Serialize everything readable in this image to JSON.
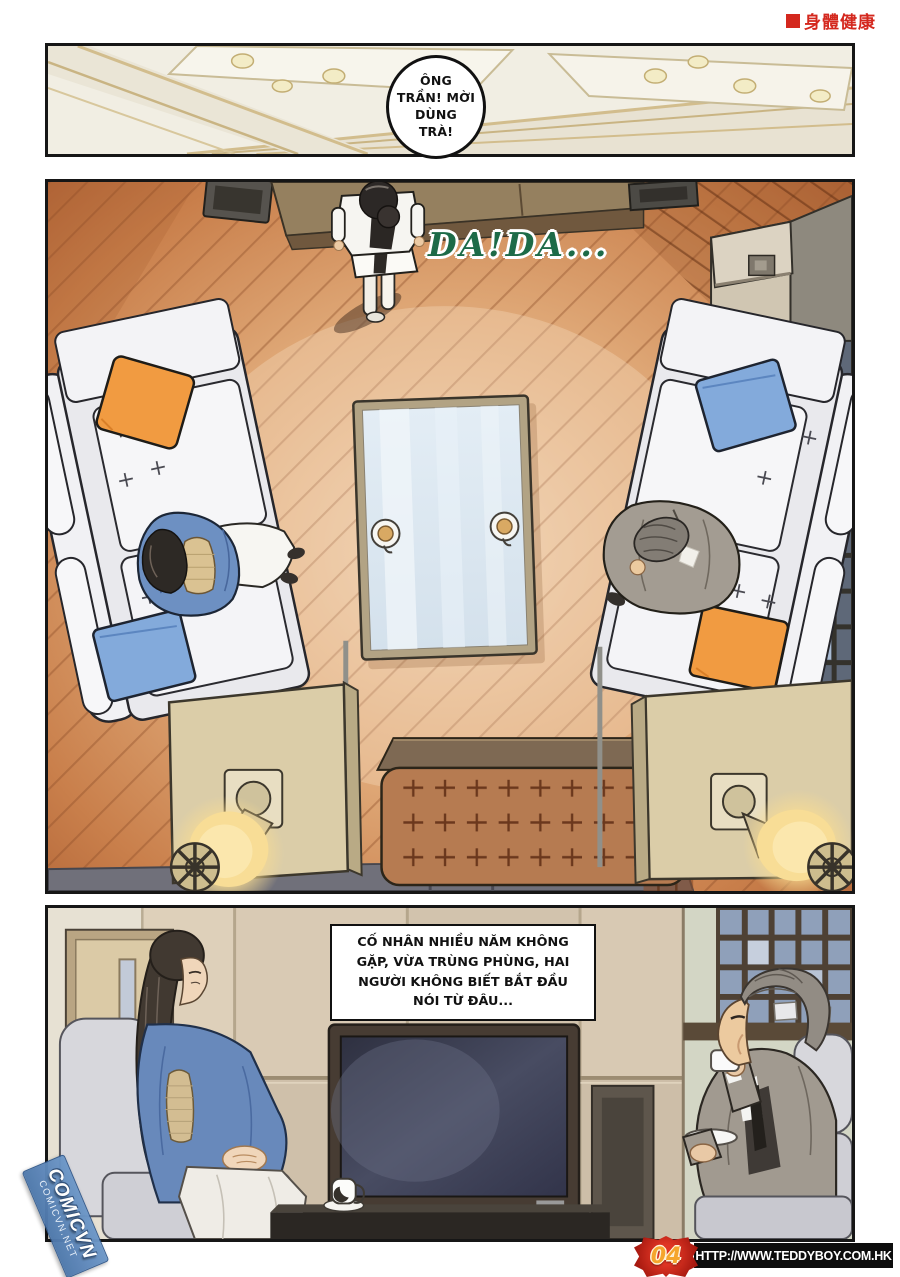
{
  "header": {
    "marker": "■",
    "text": "身體健康",
    "color": "#d4281e"
  },
  "panel1": {
    "bubble": {
      "lines": [
        "ÔNG",
        "TRẦN! MỜI",
        "DÙNG",
        "TRÀ!"
      ]
    }
  },
  "panel2": {
    "sfx": {
      "text": "DA!DA...",
      "color": "#1d6b48"
    }
  },
  "panel3": {
    "narration": {
      "lines": [
        "CỐ NHÂN NHIỀU NĂM KHÔNG",
        "GẶP, VỪA TRÙNG PHÙNG, HAI",
        "NGƯỜI KHÔNG BIẾT BẮT ĐẦU",
        "NÓI TỪ ĐÂU..."
      ]
    }
  },
  "watermark": {
    "main": "COMICVN",
    "sub": "COMICVN.NET",
    "color": "#5c86bb"
  },
  "footer": {
    "page_number": "04",
    "url": "HTTP://WWW.TEDDYBOY.COM.HK",
    "badge_color": "#c0261b",
    "number_color": "#f5a52c",
    "bar_color": "#0d0d0d"
  }
}
